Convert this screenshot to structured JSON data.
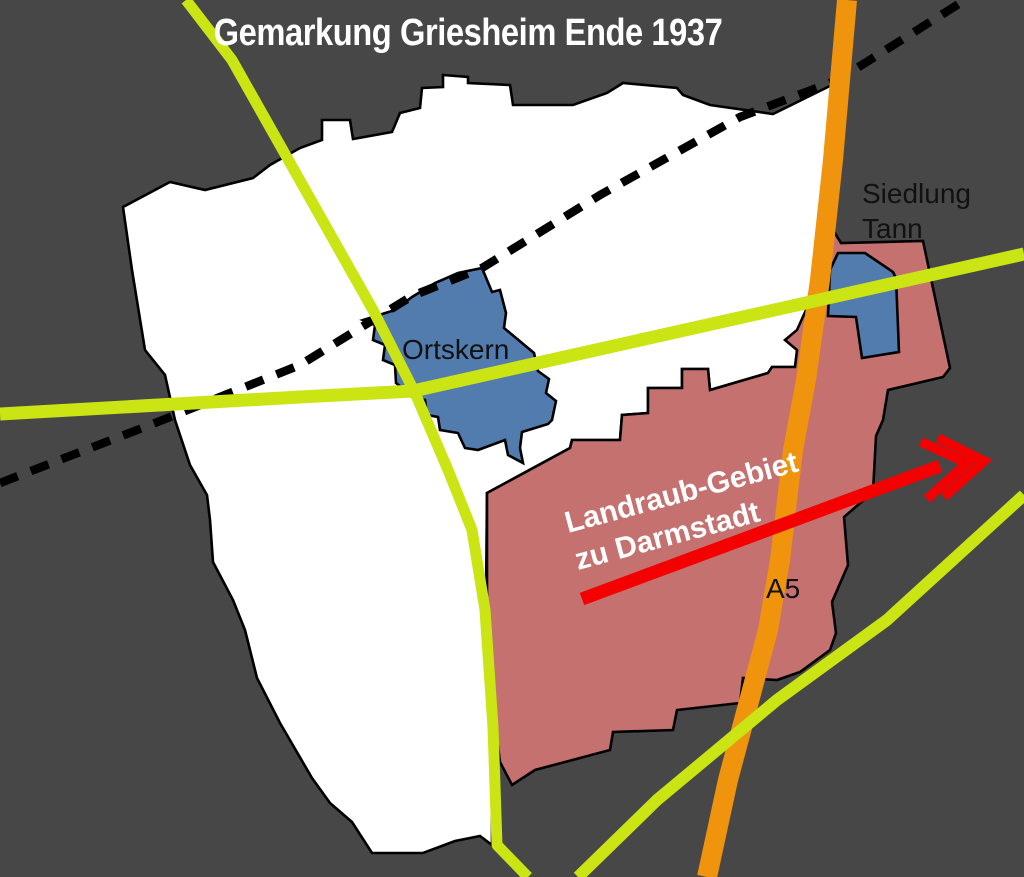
{
  "map": {
    "title": "Gemarkung Griesheim Ende 1937",
    "labels": {
      "ortskern": "Ortskern",
      "siedlung_line1": "Siedlung",
      "siedlung_line2": "Tann",
      "landraub_line1": "Landraub-Gebiet",
      "landraub_line2": "zu Darmstadt",
      "autobahn": "A5"
    }
  },
  "colors": {
    "background": "#474747",
    "gemarkung_fill": "#ffffff",
    "ortskern_fill": "#537cae",
    "landraub_fill": "#c47170",
    "siedlung_tann_fill": "#537cae",
    "road_yellow": "#cae414",
    "road_orange": "#f0930d",
    "railway_black": "#000000",
    "arrow_red": "#f40000",
    "outline_black": "#000000",
    "title_text": "#ffffff",
    "label_text": "#111111"
  }
}
